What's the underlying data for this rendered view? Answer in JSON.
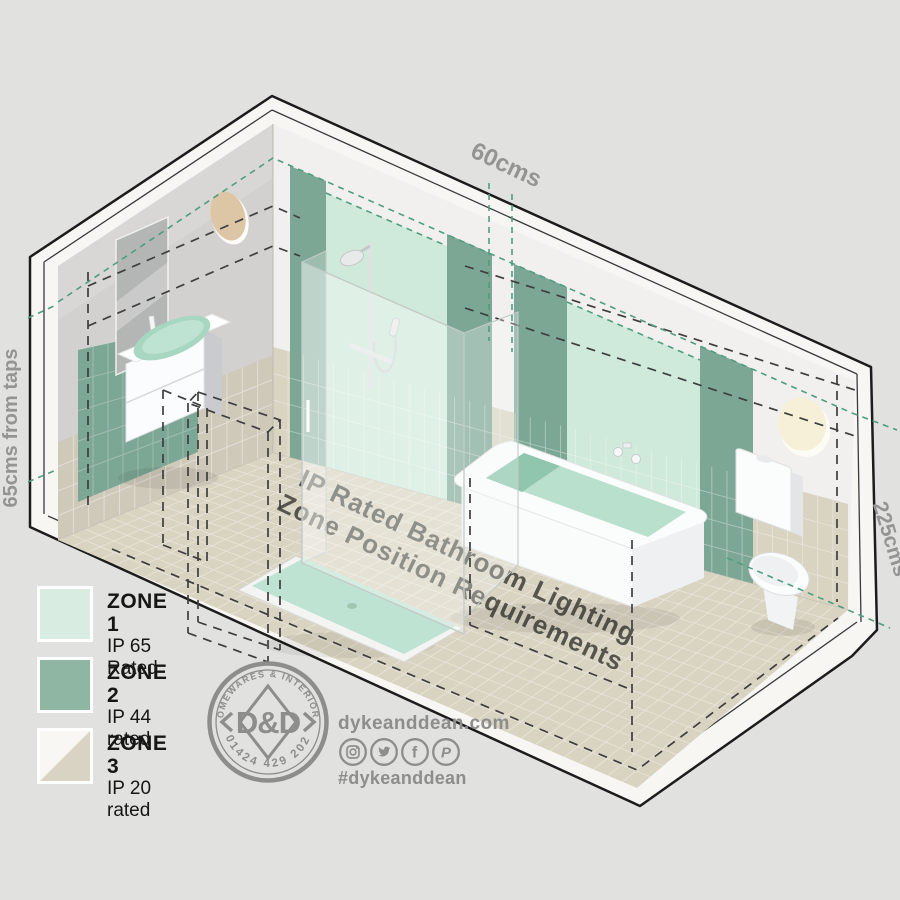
{
  "scene": {
    "dims": {
      "top": "60cms",
      "left": "65cms from taps",
      "right": "225cms"
    },
    "title": {
      "line1": "IP Rated Bathroom Lighting",
      "line2": "Zone Position Requirements"
    },
    "fixtures": [
      "mirror",
      "basin-vanity",
      "shower-enclosure",
      "bathtub",
      "toilet",
      "wall-light-left",
      "wall-light-right",
      "door-outline"
    ]
  },
  "legend": {
    "items": [
      {
        "zone": "ZONE 1",
        "rating": "IP 65 Rated",
        "color": "#d9ece1"
      },
      {
        "zone": "ZONE 2",
        "rating": "IP 44 rated",
        "color": "#8eb6a3"
      },
      {
        "zone": "ZONE 3",
        "rating": "IP 20 rated",
        "color_top": "#f8f7f3",
        "color_bottom": "#d9d3c3"
      }
    ]
  },
  "logo": {
    "arc_top": "HOMEWARES & INTERIORS",
    "arc_bottom": "01424 429 202",
    "monogram": "D&D"
  },
  "contact": {
    "website": "dykeanddean.com",
    "hashtag": "#dykeanddean",
    "social_icons": [
      "instagram",
      "twitter",
      "facebook",
      "pinterest"
    ]
  },
  "colors": {
    "background": "#e1e1e0",
    "zone1_mint": "#cfe9da",
    "zone2_green": "#7da795",
    "zone3_beige": "#d9d3c2",
    "teal_dash": "#4f9e7e",
    "black_dash": "#3e3e3e",
    "label_gray": "#949494",
    "title_gray": "#56554d",
    "logo_gray": "#8d8d8d"
  }
}
